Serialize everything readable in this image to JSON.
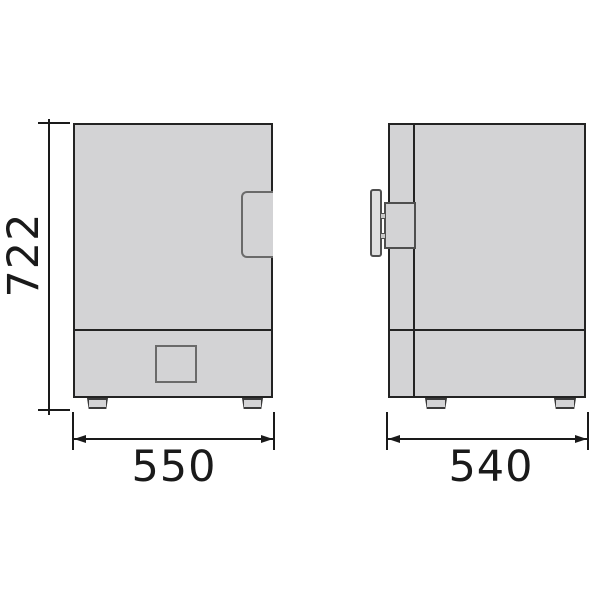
{
  "dimensions": {
    "height": "722",
    "width": "550",
    "depth": "540"
  },
  "colors": {
    "background": "#ffffff",
    "body_fill": "#d3d3d5",
    "outline": "#232323",
    "detail_outline": "#6a6a6a",
    "dimension": "#1a1a1a"
  }
}
